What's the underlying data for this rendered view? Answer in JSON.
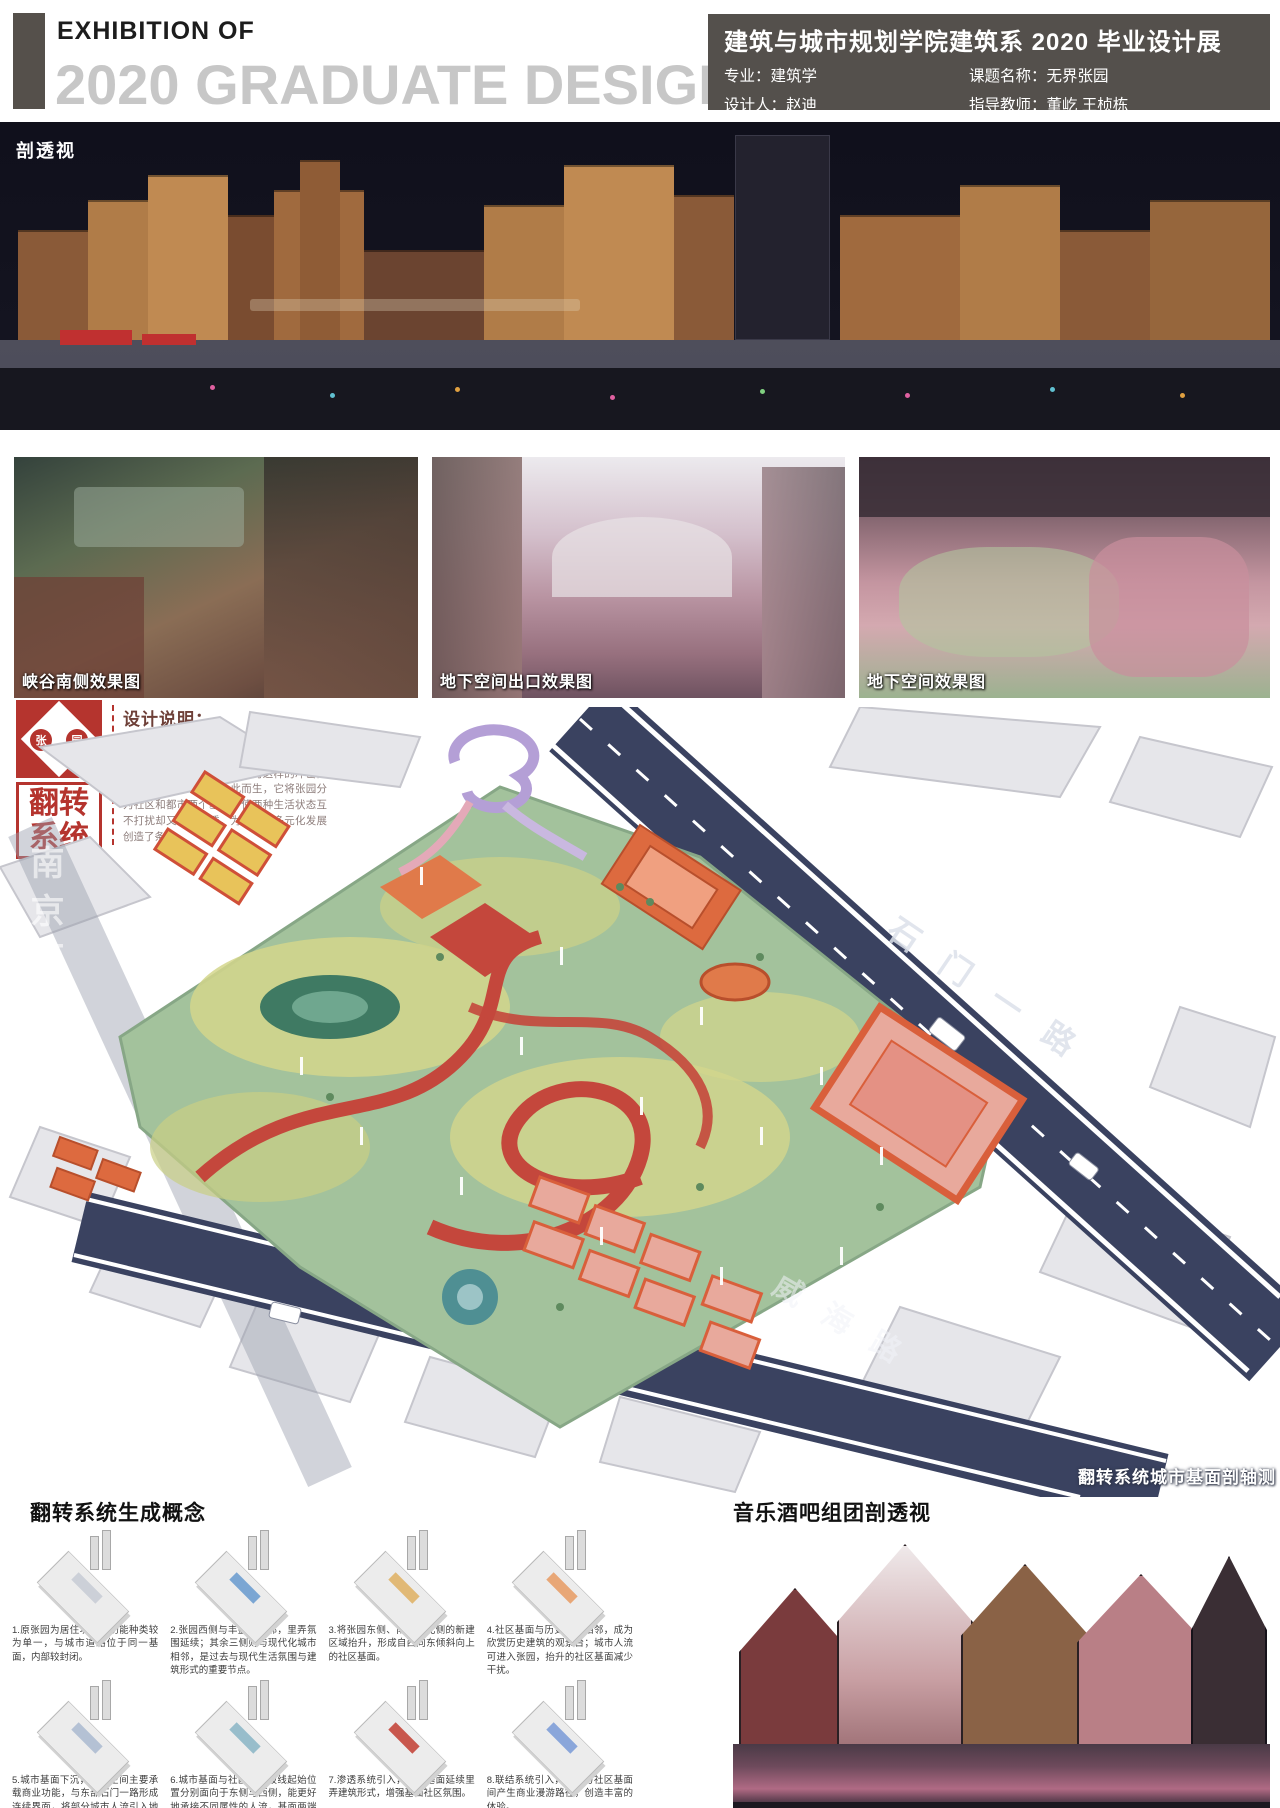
{
  "header": {
    "exhibition_label": "EXHIBITION OF",
    "title": "2020 GRADUATE DESIGN",
    "info_title": "建筑与城市规划学院建筑系 2020 毕业设计展",
    "major": "专业：建筑学",
    "topic": "课题名称：无界张园",
    "designer": "设计人：赵迪",
    "advisor": "指导教师：董屹 王桢栋"
  },
  "panorama": {
    "caption": "剖透视"
  },
  "renderings": [
    {
      "caption": "峡谷南侧效果图"
    },
    {
      "caption": "地下空间出口效果图"
    },
    {
      "caption": "地下空间效果图"
    }
  ],
  "design_notes": {
    "title": "设计说明：",
    "body": "城市的更新给张园带来了机遇和压力，城市人群的进入让张园充满商机与活力，但同时张园本身的社区私密感也因为这样的冲击而消失。翻转系统就是为此而生，它将张园分为社区和都市两个基面，使两种生活状态互不打扰却又相互渗透，为张园的多元化发展创造了条件。"
  },
  "flip_seal": {
    "stamp_chars": [
      "张",
      "园"
    ],
    "label_line1": "翻转",
    "label_line2": "系统"
  },
  "axon": {
    "street_left": "南京西路",
    "street_right": "石门一路",
    "street_bottom": "威海路",
    "caption": "翻转系统城市基面剖轴测",
    "colors": {
      "road": "#3a4260",
      "park": "#a3c29c",
      "path_red": "#c4473c",
      "building_orange": "#dd6a3f"
    }
  },
  "concept": {
    "title": "翻转系统生成概念",
    "steps": [
      {
        "text": "1.原张园为居住功能，功能种类较为单一，与城市道路位于同一基面，内部较封闭。",
        "accent": "#c9cdd6"
      },
      {
        "text": "2.张园西侧与丰盛里相邻，里弄氛围延续；其余三侧则与现代化城市相邻，是过去与现代生活氛围与建筑形式的重要节点。",
        "accent": "#6f9fd0"
      },
      {
        "text": "3.将张园东侧、南侧、北侧的新建区域抬升，形成自西向东倾斜向上的社区基面。",
        "accent": "#e0b469"
      },
      {
        "text": "4.社区基面与历史街区相邻，成为欣赏历史建筑的观景台；城市人流可进入张园，抬升的社区基面减少干扰。",
        "accent": "#e8a06a"
      },
      {
        "text": "5.城市基面下沉，地下空间主要承载商业功能，与东部石门一路形成连续界面，将部分城市人流引入地下商业区。",
        "accent": "#aebdd2"
      },
      {
        "text": "6.城市基面与社区基面坡线起始位置分别面向于东侧与西侧，能更好地承接不同属性的人流，基面两端通过垂直交通点相连。",
        "accent": "#8fb8c8"
      },
      {
        "text": "7.渗透系统引入，社区基面延续里弄建筑形式，增强基面社区氛围。",
        "accent": "#c4473c"
      },
      {
        "text": "8.联结系统引入，城市与社区基面间产生商业漫游路径，创造丰富的体验。",
        "accent": "#7f9fd8"
      }
    ]
  },
  "music_bar": {
    "title": "音乐酒吧组团剖透视"
  }
}
